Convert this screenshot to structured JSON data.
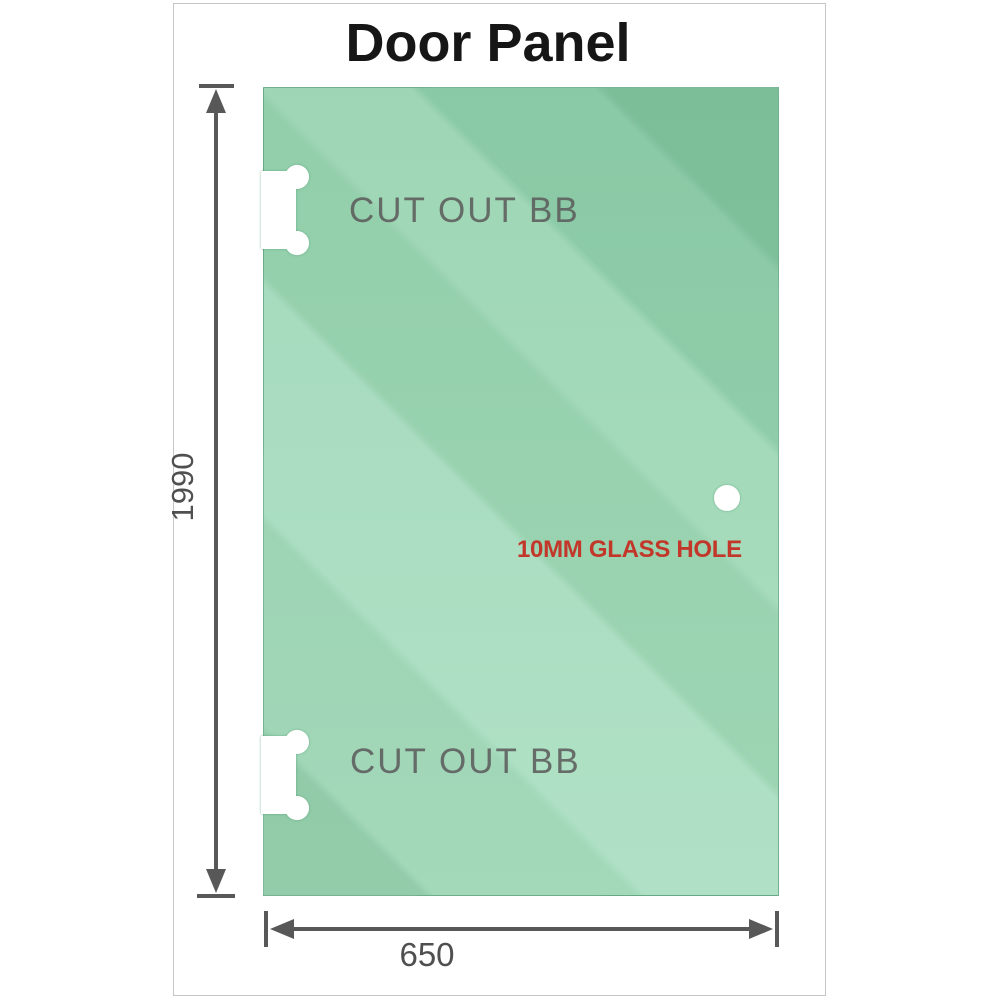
{
  "title": "Door Panel",
  "dimensions": {
    "height": "1990",
    "width": "650"
  },
  "panel": {
    "cutouts": [
      {
        "label": "CUT OUT BB"
      },
      {
        "label": "CUT OUT BB"
      }
    ],
    "hole_label": "10MM GLASS HOLE"
  },
  "colors": {
    "glass_green": "#93d0ac",
    "glass_light_band": "#abdfc2",
    "glass_dark_band": "#7fc29b",
    "dimension_gray": "#585858",
    "cutout_label_gray": "#5c5c5c",
    "hole_label_red": "#c2372a",
    "frame_border_gray": "#c5c5c5",
    "title_black": "#161616"
  }
}
